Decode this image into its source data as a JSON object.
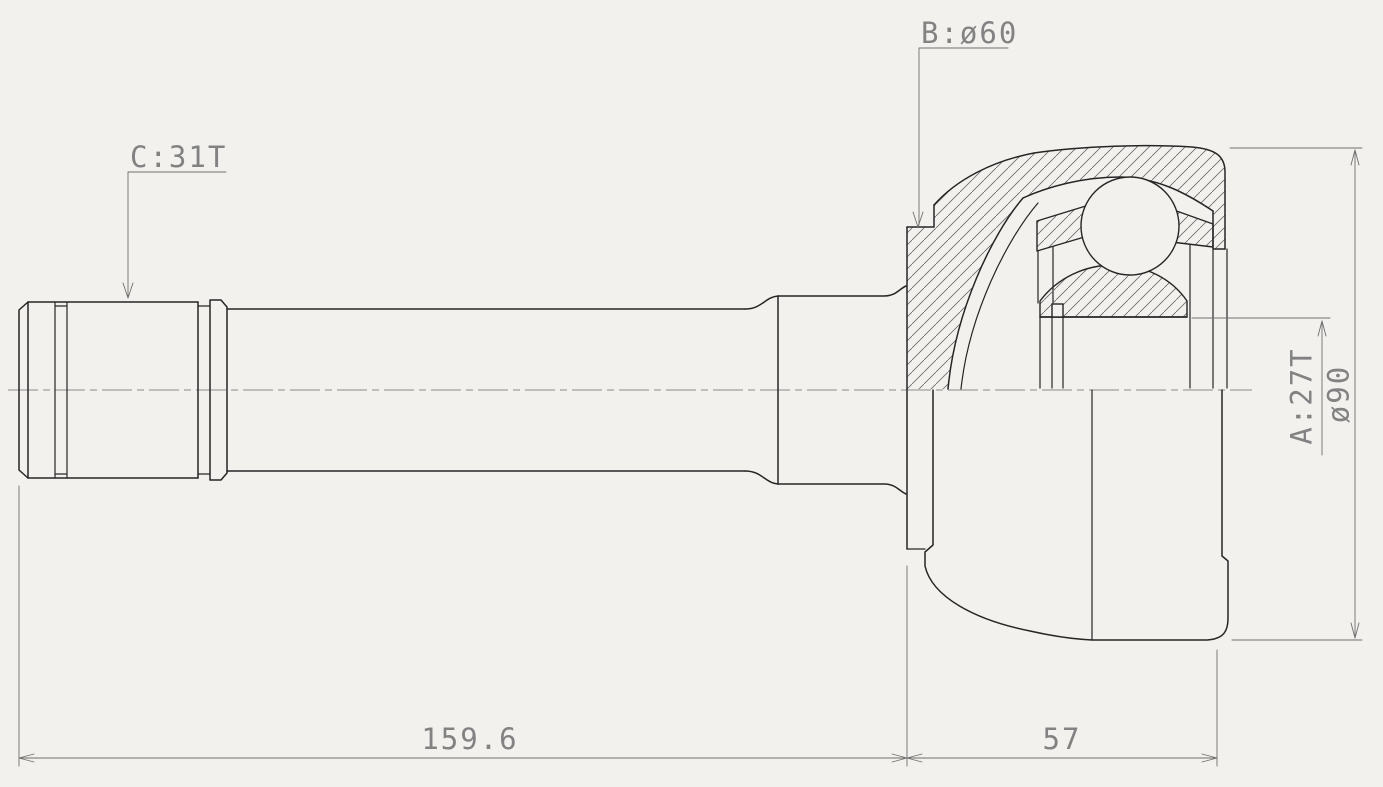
{
  "drawing": {
    "callouts": {
      "label_c": "C:31T",
      "label_b": "B:ø60"
    },
    "dimensions": {
      "label_a": "A:27T",
      "outer_diameter": "ø90",
      "length_shaft": "159.6",
      "length_joint": "57"
    },
    "colors": {
      "background": "#f2f1ee",
      "line": "#262626",
      "thin": "#6f6f6f",
      "text": "#828282"
    }
  }
}
